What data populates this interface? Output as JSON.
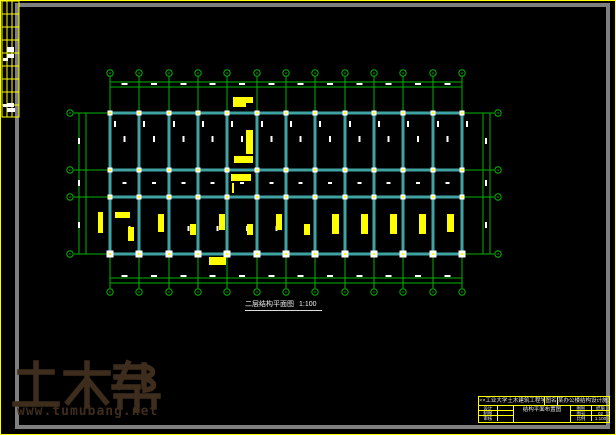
{
  "colors": {
    "bg": "#000000",
    "frame_yellow": "#ffff00",
    "frame_gray": "#7f7f7f",
    "axis_green": "#00b400",
    "beam_cyan": "#3fa3a3",
    "mark_white": "#ffffff",
    "annotation_yellow": "#ffff00",
    "watermark_brown": "#3e2d1c"
  },
  "watermark": {
    "brand": "土木帮",
    "url": "www.tumubang.net"
  },
  "drawing_label": {
    "name": "二层结构平面图",
    "scale": "1:100"
  },
  "title_block": {
    "org": "××工业大学土木建筑工程学院",
    "name_label": "图名",
    "project": "某办公楼结构设计施工图",
    "drawing_name": "结构平面布置图",
    "left_rows": [
      [
        "设计",
        ""
      ],
      [
        "制图",
        ""
      ],
      [
        "审核",
        ""
      ]
    ],
    "right_rows": [
      [
        "图别",
        "结施"
      ],
      [
        "图号",
        "02"
      ],
      [
        "比例",
        "1:100"
      ]
    ]
  },
  "sign_table": {
    "x": 2,
    "y": 1,
    "w": 17,
    "h": 116,
    "col_offsets": [
      5,
      10
    ],
    "row_offsets": [
      13,
      26,
      39,
      52,
      65,
      78,
      91,
      104
    ],
    "marks": [
      [
        7,
        47,
        7,
        5
      ],
      [
        7,
        54,
        7,
        4
      ],
      [
        3,
        58,
        5,
        3
      ],
      [
        7,
        103,
        7,
        4
      ],
      [
        7,
        108,
        8,
        4
      ],
      [
        3,
        104,
        4,
        3
      ]
    ]
  },
  "plan": {
    "column_xs": [
      110,
      139,
      169,
      198,
      227,
      257,
      286,
      315,
      345,
      374,
      403,
      433,
      462
    ],
    "row_ys": [
      113,
      170,
      197,
      254
    ],
    "axis_extent": {
      "col_y1": 76,
      "col_y2": 288,
      "row_x1": 74,
      "row_x2": 494
    },
    "bubbles": {
      "top_cy": 73,
      "bottom_cy": 292,
      "left_cx": 70,
      "right_cx": 498,
      "r": 3.2
    },
    "dim_lines": {
      "top": [
        82,
        87
      ],
      "bottom": [
        278,
        283
      ],
      "left": [
        79,
        86
      ],
      "right": [
        483,
        490
      ],
      "h_x1": 110,
      "h_x2": 462,
      "v_y1": 113,
      "v_y2": 254
    },
    "dim_tick_rows": {
      "top_y": 83,
      "bottom_y": 275,
      "left_x": 78,
      "right_x": 485,
      "side_centers": [
        138,
        180,
        222
      ]
    },
    "interior_dashes": {
      "upper_y": 136,
      "corridor_y": 182,
      "lower_y": 226
    },
    "beam_width": 3,
    "column_mark": {
      "size": 5,
      "bottom_size": 7
    },
    "annotations": [
      [
        233,
        97,
        20,
        6
      ],
      [
        233,
        103,
        13,
        4
      ],
      [
        246,
        130,
        7,
        24
      ],
      [
        234,
        156,
        19,
        7
      ],
      [
        231,
        174,
        20,
        7
      ],
      [
        209,
        257,
        17,
        8
      ],
      [
        98,
        212,
        5,
        21
      ],
      [
        115,
        212,
        15,
        6
      ],
      [
        128,
        227,
        6,
        14
      ],
      [
        158,
        214,
        6,
        18
      ],
      [
        190,
        224,
        6,
        11
      ],
      [
        219,
        214,
        6,
        16
      ],
      [
        247,
        224,
        6,
        11
      ],
      [
        276,
        214,
        6,
        16
      ],
      [
        304,
        224,
        6,
        11
      ],
      [
        332,
        214,
        7,
        20
      ],
      [
        361,
        214,
        7,
        20
      ],
      [
        390,
        214,
        7,
        20
      ],
      [
        419,
        214,
        7,
        20
      ],
      [
        447,
        214,
        7,
        18
      ],
      [
        232,
        183,
        2,
        10
      ]
    ]
  }
}
